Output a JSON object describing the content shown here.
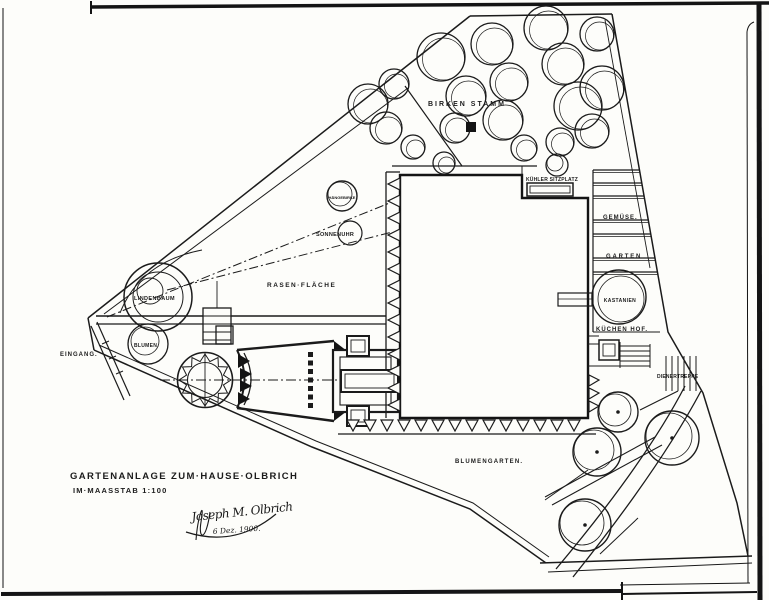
{
  "sheet": {
    "title": "GARTENANLAGE ZUM·HAUSE·OLBRICH",
    "scale": "IM·MAASSTAB 1:100",
    "signature": "Joseph M. Olbrich",
    "date": "6 Dez. 1900.",
    "ink_color": "#1b1b1b",
    "paper_color": "#fdfdfa"
  },
  "labels": {
    "birken": "BIRKEN STAMM",
    "kuehler_sitzplatz": "KÜHLER SITZPLATZ",
    "gemuese": "GEMÜSE.",
    "garten": "GARTEN",
    "kastanien": "KASTANIEN",
    "kuechen_hof": "KÜCHEN HOF.",
    "dienertreppe": "DIENERTREPPE",
    "rasen": "RASEN·FLÄCHE",
    "sonnenuhr": "SONNENUHR",
    "haengebirke": "HÄNGEBIRKE",
    "lindenbaum": "LINDENBAUM",
    "blumen": "BLUMEN.",
    "eingang": "EINGANG.",
    "blumengarten": "BLUMENGARTEN."
  }
}
